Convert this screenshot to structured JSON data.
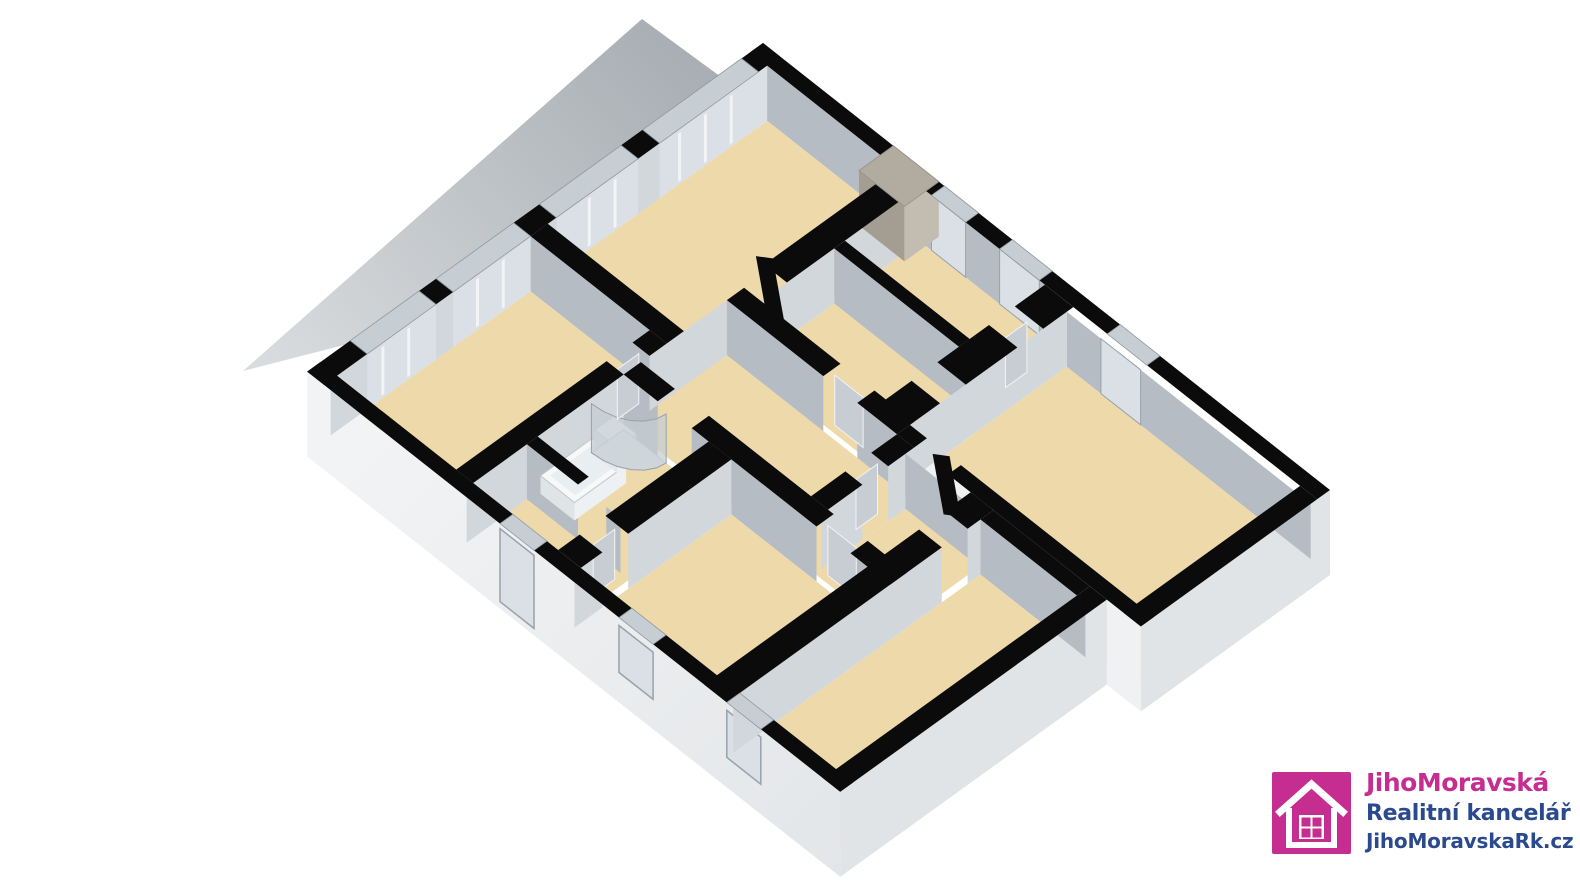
{
  "app": {
    "kind": "3d-floorplan-render",
    "background": "#ffffff"
  },
  "palette": {
    "background": "#ffffff",
    "terrace_near": "#d7dadd",
    "terrace_far": "#aab0b5",
    "floor": "#eed9aa",
    "wall_top": "#0b0b0b",
    "face_down_left": "#b5bcc4",
    "face_down_right": "#d2d7dc",
    "exterior_face_light": "#eff1f2",
    "exterior_face_dark": "#e0e4e7",
    "glass_top": "#c6cdd3",
    "glass_face": "#dae0e5",
    "glass_frame": "#97a2ab",
    "mullion": "#f2f4f6",
    "door_leaf": "#c7cdd2",
    "chimney_top": "#b2ab9f",
    "chimney_face_light": "#c3bcb1",
    "chimney_face_dark": "#a49d92",
    "fixture_white": "#f7f9f9",
    "fixture_inner": "#e9eef0",
    "fixture_line": "#bfc7cc",
    "logo_magenta": "#c62d90",
    "logo_navy": "#2b4a8e"
  },
  "logo": {
    "icon": "house-icon",
    "line1": "JihoMoravská",
    "line2": "Realitní kancelář",
    "line3": "JihoMoravskaRk.cz"
  }
}
